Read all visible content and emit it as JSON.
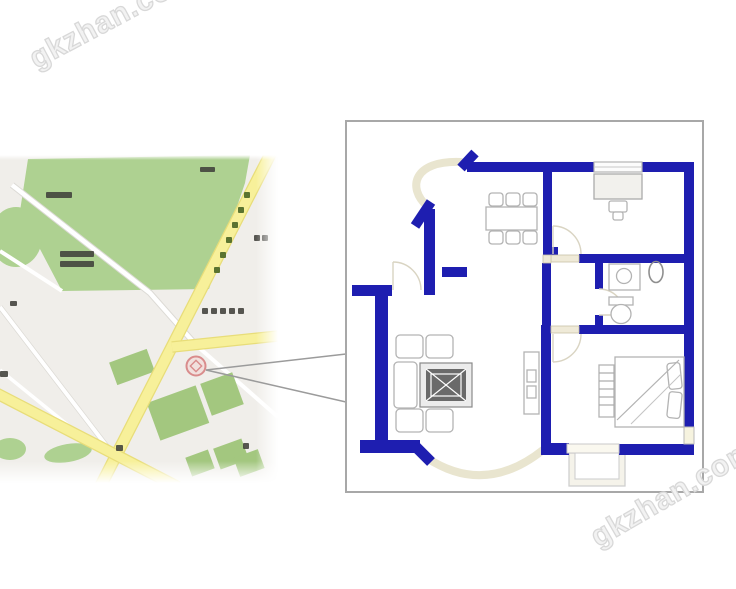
{
  "watermarks": {
    "top_left": "gkzhan.com",
    "bottom_right": "gkzhan.com"
  },
  "colors": {
    "wall": "#1e1eb0",
    "plan_border": "#a8a8a8",
    "map_bg": "#f0eeea",
    "park": "#aed191",
    "patch": "#a3c77f",
    "road_y": "#f7f09a",
    "road_y_edge": "#e8dd79",
    "marker_red": "#d98c8c",
    "callout": "#9b9b9b",
    "cream": "#e9e5cf",
    "furn": "#b3b3b3",
    "label_dark": "#40403a",
    "tree": "#5a7330",
    "wm": "#d8d8d8"
  }
}
